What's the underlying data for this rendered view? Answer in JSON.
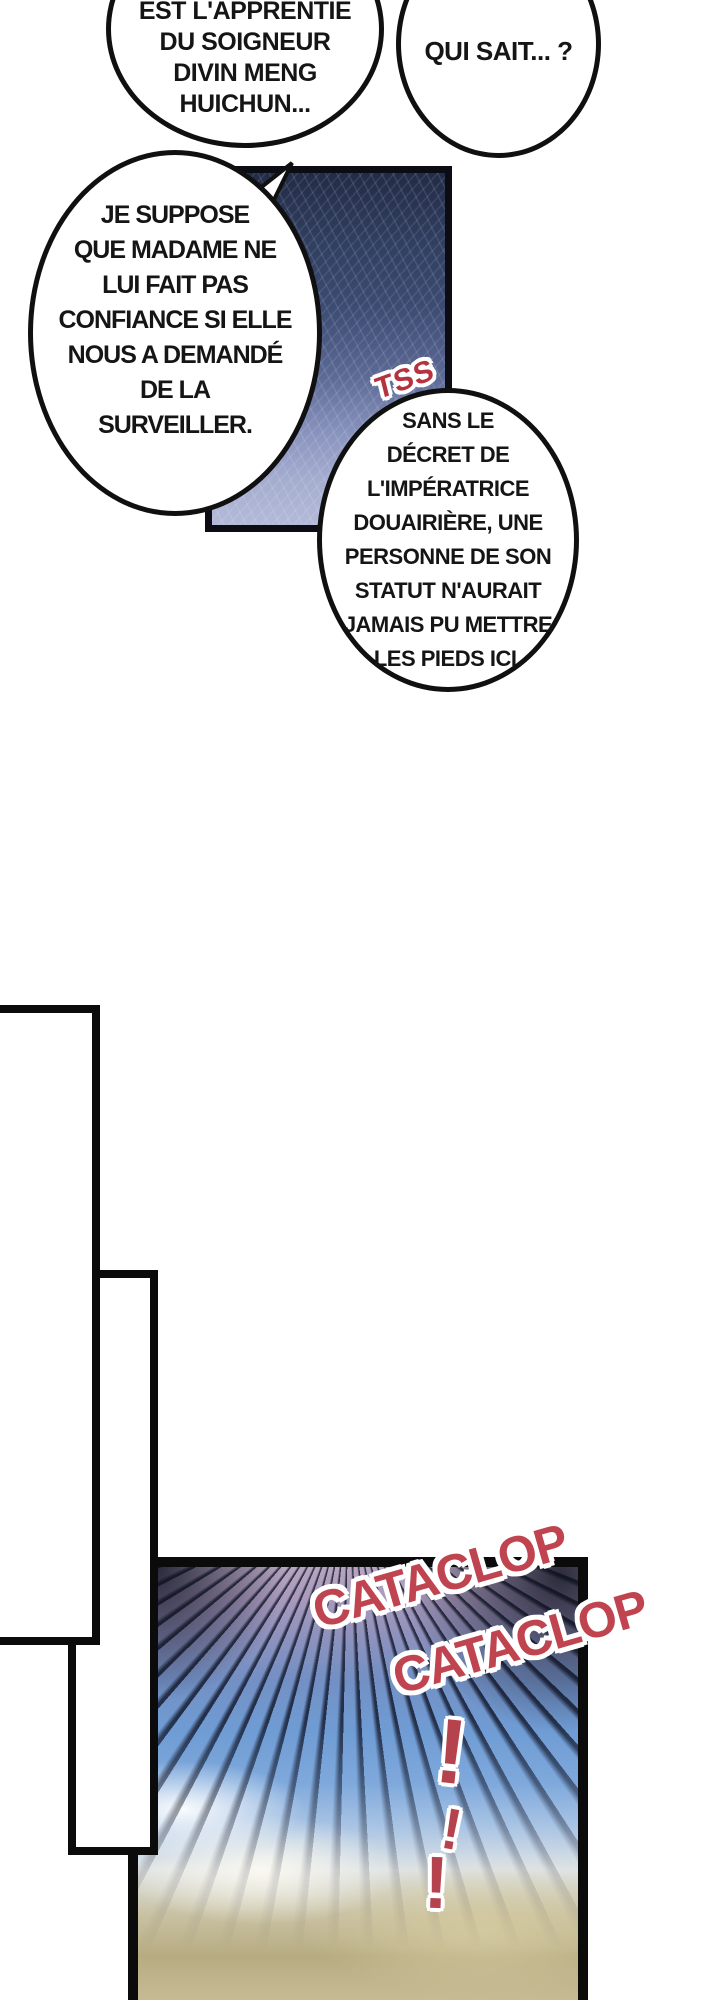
{
  "page": {
    "width": 720,
    "height": 2000,
    "background": "#ffffff"
  },
  "bubbles": [
    {
      "name": "bubble-apprentie",
      "lines": [
        "EST L'APPRENTIE",
        "DU SOIGNEUR",
        "DIVIN MENG",
        "HUICHUN..."
      ]
    },
    {
      "name": "bubble-qui-sait",
      "lines": [
        "QUI SAIT... ?"
      ]
    },
    {
      "name": "bubble-je-suppose",
      "lines": [
        "JE SUPPOSE",
        "QUE MADAME NE",
        "LUI FAIT PAS",
        "CONFIANCE SI ELLE",
        "NOUS A DEMANDÉ",
        "DE LA",
        "SURVEILLER."
      ]
    },
    {
      "name": "bubble-sans-le-decret",
      "lines": [
        "SANS LE",
        "DÉCRET DE",
        "L'IMPÉRATRICE",
        "DOUAIRIÈRE, UNE",
        "PERSONNE DE SON",
        "STATUT N'AURAIT",
        "JAMAIS PU METTRE",
        "LES PIEDS ICI."
      ]
    }
  ],
  "sfx": {
    "tss": "TSS",
    "cataclop_1": "CATACLOP",
    "cataclop_2": "CATACLOP",
    "exclamation_1": "!",
    "exclamation_2": "!",
    "exclamation_3": "!"
  },
  "colors": {
    "sfx_red": "#bf4450",
    "ink": "#101010",
    "panel_navy_dark": "#2c3854",
    "panel_slate_light": "#a9b1d2",
    "sky_pink": "#b7a6c0",
    "sky_blue": "#6f9cd4",
    "cloud_tan": "#b7ab80"
  }
}
